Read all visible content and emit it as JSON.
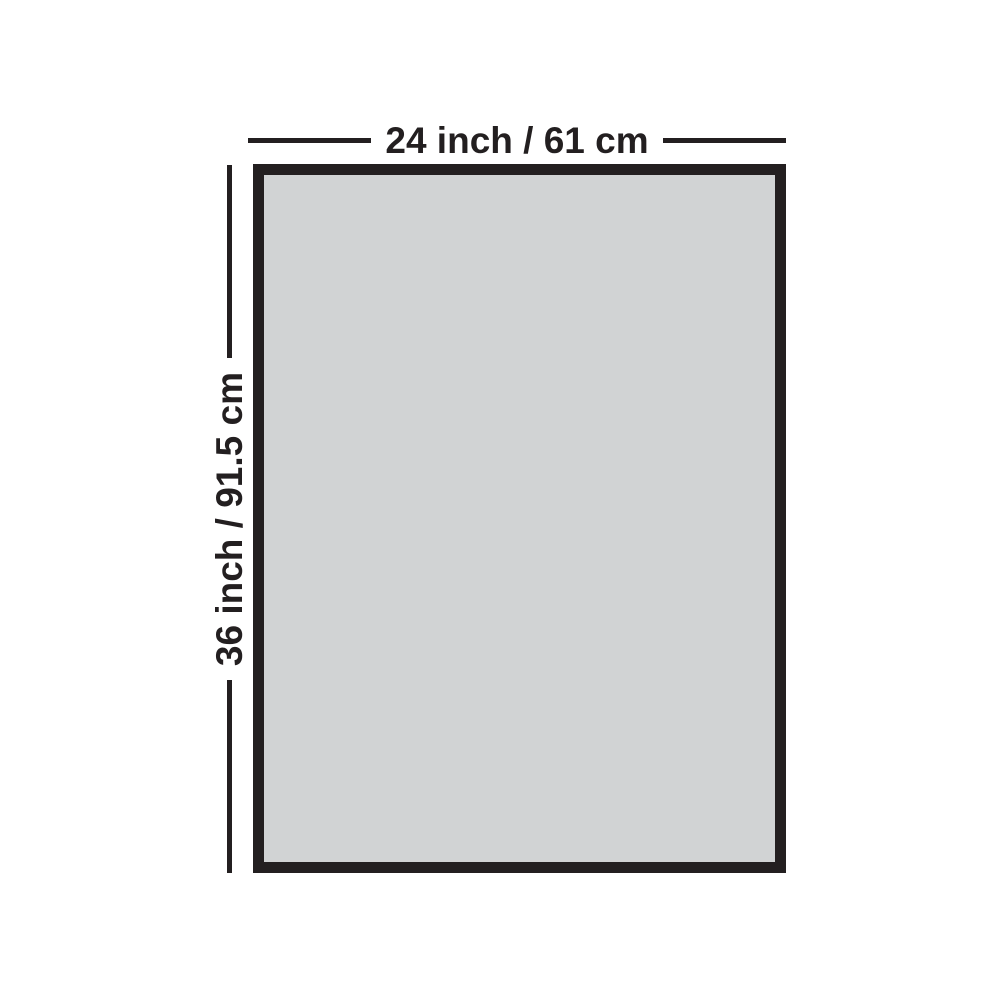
{
  "diagram": {
    "width_label": "24 inch / 61 cm",
    "height_label": "36 inch / 91.5 cm"
  },
  "colors": {
    "ink": "#231f20",
    "fill": "#d1d3d4",
    "background": "#ffffff"
  }
}
